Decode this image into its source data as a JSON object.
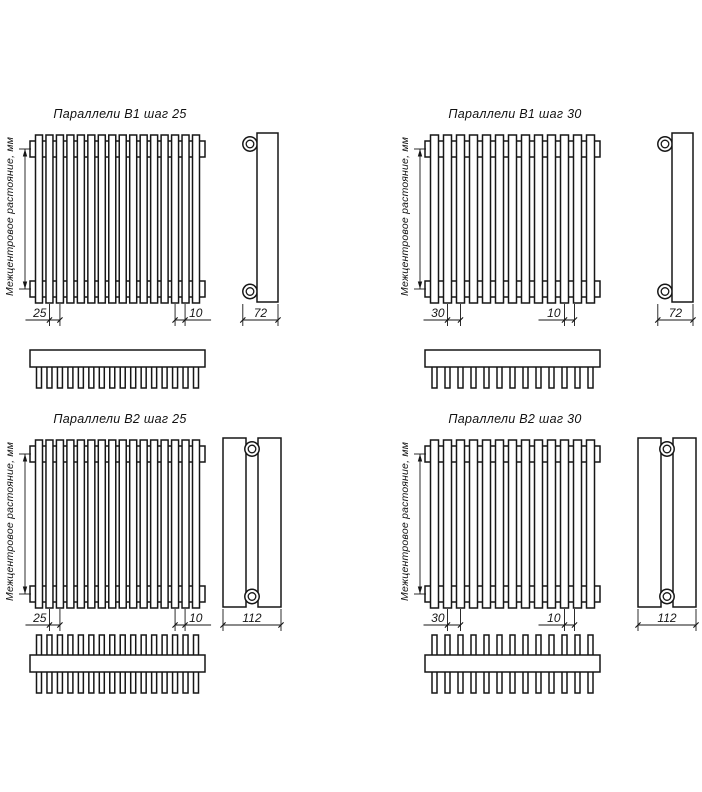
{
  "drawing": {
    "background": "#ffffff",
    "line_color": "#161616",
    "axis_label": "Межцентровое растояние, мм",
    "quadrants": [
      {
        "id": "b1-25",
        "title": "Параллели В1 шаг 25",
        "tubes": 16,
        "rows": "single",
        "pitch_label": "25",
        "tube_label": "10",
        "tube_label_side": "right",
        "depth_label": "72"
      },
      {
        "id": "b1-30",
        "title": "Параллели В1 шаг 30",
        "tubes": 13,
        "rows": "single",
        "pitch_label": "30",
        "tube_label": "10",
        "tube_label_side": "left",
        "depth_label": "72"
      },
      {
        "id": "b2-25",
        "title": "Параллели В2 шаг 25",
        "tubes": 16,
        "rows": "double",
        "pitch_label": "25",
        "tube_label": "10",
        "tube_label_side": "right",
        "depth_label": "112"
      },
      {
        "id": "b2-30",
        "title": "Параллели В2 шаг 30",
        "tubes": 13,
        "rows": "double",
        "pitch_label": "30",
        "tube_label": "10",
        "tube_label_side": "left",
        "depth_label": "112"
      }
    ]
  }
}
